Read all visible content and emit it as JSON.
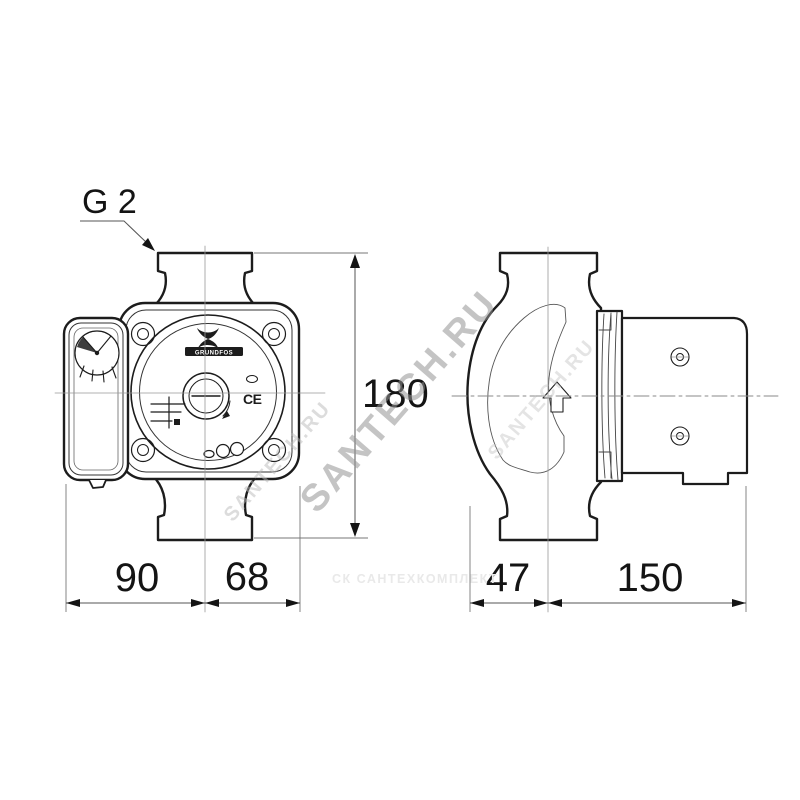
{
  "labels": {
    "thread_size": "G 2",
    "dim_height": "180",
    "dim_width_left": "90",
    "dim_width_right": "68",
    "dim_depth_front": "47",
    "dim_depth_rear": "150"
  },
  "front_view": {
    "brand": "GRUNDFOS",
    "ce": "CE"
  },
  "watermarks": {
    "diagonal_main": "SANTECH.RU",
    "diagonal_faint_left": "SANTECH.RU",
    "diagonal_faint_right": "SANTECH.RU",
    "bottom_caption": "СК САНТЕХКОМПЛЕКТ"
  },
  "colors": {
    "outline": "#1c1c1c",
    "thin_line": "#999999",
    "dimension_line": "#555555",
    "text": "#141414",
    "watermark": "#949494"
  }
}
